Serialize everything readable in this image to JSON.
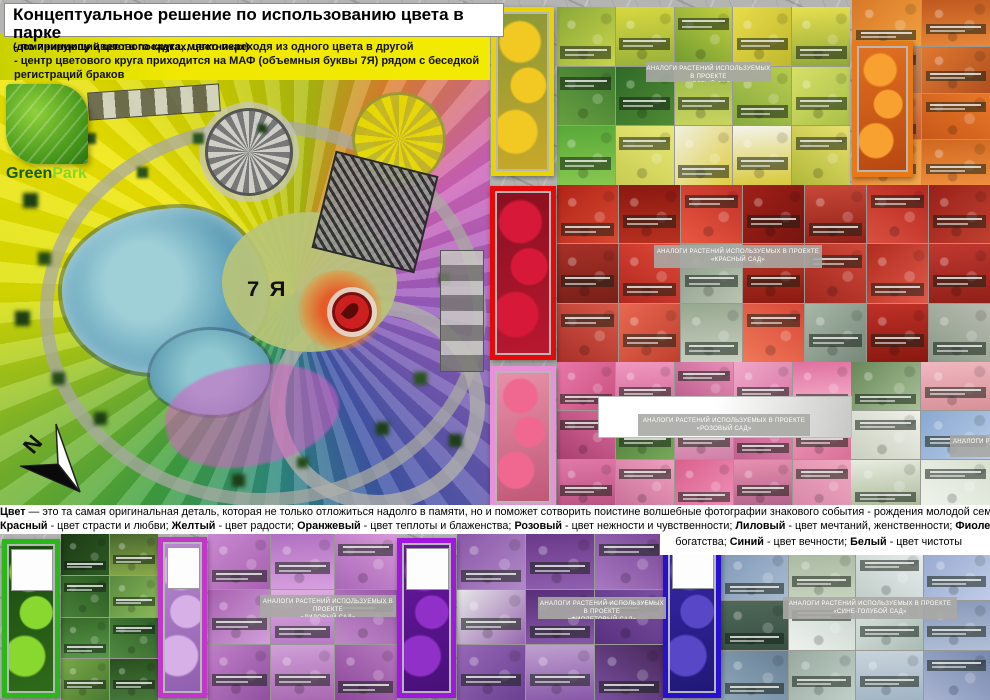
{
  "header": {
    "title": "Концептуальное решение по использованию цвета в парке",
    "subtitle": "(доминирующий цвет в посадках, цветниках)"
  },
  "notes": {
    "line1": "- по принципу цветового круга, мягко переходя из одного цвета в другой",
    "line2": "- центр цветового круга приходится на МАФ (объемныя буквы 7Я) рядом с беседкой регистраций браков"
  },
  "logo": {
    "word1": "Green",
    "word2": "Park"
  },
  "plan": {
    "center_label": "7 Я",
    "compass_letter": "N"
  },
  "description": {
    "line1": [
      {
        "t": "Цвет",
        "b": 1
      },
      {
        "t": " — это та самая оригинальная деталь, которая не только отложиться надолго в памяти, но и поможет  сотворить поистине волшебные фотографии знакового события - рождения молодой семьи."
      }
    ],
    "line2": [
      {
        "t": "Красный",
        "b": 1
      },
      {
        "t": " - цвет страсти и любви; "
      },
      {
        "t": "Желтый",
        "b": 1
      },
      {
        "t": " - цвет радости; "
      },
      {
        "t": "Оранжевый",
        "b": 1
      },
      {
        "t": " - цвет теплоты и блаженства; "
      },
      {
        "t": "Розовый",
        "b": 1
      },
      {
        "t": " - цвет нежности и чувственности; "
      },
      {
        "t": "Лиловый",
        "b": 1
      },
      {
        "t": " - цвет мечтаний, женственности; "
      },
      {
        "t": "Фиолетовый",
        "b": 1
      },
      {
        "t": " - цвет роскоши"
      }
    ],
    "line3": [
      {
        "t": "богатства; "
      },
      {
        "t": "Синий",
        "b": 1
      },
      {
        "t": " - цвет вечности; "
      },
      {
        "t": "Белый",
        "b": 1
      },
      {
        "t": "  - цвет чистоты"
      }
    ]
  },
  "sections": {
    "yellow": {
      "label": "АНАЛОГИ РАСТЕНИЙ ИСПОЛЬЗУЕМЫХ В ПРОЕКТЕ\n«ЖЕЛТЫЙ САД»"
    },
    "red": {
      "label": "АНАЛОГИ РАСТЕНИЙ ИСПОЛЬЗУЕМЫХ В ПРОЕКТЕ\n«КРАСНЫЙ САД»"
    },
    "pink": {
      "label": "АНАЛОГИ РАСТЕНИЙ ИСПОЛЬЗУЕМЫХ В ПРОЕКТЕ\n«РОЗОВЫЙ САД»"
    },
    "white": {
      "label": "АНАЛОГИ РАСТЕНИЙ ИСПОЛЬЗУЕМЫХ В ПРОЕКТЕ"
    },
    "lilac": {
      "label": "АНАЛОГИ РАСТЕНИЙ ИСПОЛЬЗУЕМЫХ В ПРОЕКТЕ\n«ЛИЛОВЫЙ САД»"
    },
    "violet": {
      "label": "АНАЛОГИ РАСТЕНИЙ ИСПОЛЬЗУЕМЫХ В ПРОЕКТЕ\n«ФИОЛЕТОВЫЙ САД»"
    },
    "blue": {
      "label": "АНАЛОГИ РАСТЕНИЙ ИСПОЛЬЗУЕМЫХ В ПРОЕКТЕ\n«СИНЕ-ГОЛУБОЙ САД»"
    }
  },
  "portraits": {
    "yellow": {
      "frame": "#e8d400",
      "box": false,
      "bg": [
        "#8a9838",
        "#c8a828"
      ],
      "fl": "#f2c822"
    },
    "orange": {
      "frame": "#e87818",
      "box": false,
      "bg": [
        "#e07020",
        "#b84810"
      ],
      "fl": "#f8a030"
    },
    "red": {
      "frame": "#e80808",
      "box": false,
      "bg": [
        "#8a1020",
        "#b81830"
      ],
      "fl": "#d81838"
    },
    "pink": {
      "frame": "#e890d8",
      "box": false,
      "bg": [
        "#e890a8",
        "#c05878"
      ],
      "fl": "#f06890"
    },
    "green": {
      "frame": "#28b818",
      "box": true,
      "bg": [
        "#1a4a10",
        "#2f6a1a"
      ],
      "fl": "#88d830"
    },
    "lilac": {
      "frame": "#c038c8",
      "box": true,
      "bg": [
        "#b888d0",
        "#9060b0"
      ],
      "fl": "#d8b0e8"
    },
    "purple": {
      "frame": "#a018e0",
      "box": true,
      "bg": [
        "#6a18a0",
        "#481078"
      ],
      "fl": "#9030c8"
    },
    "blue": {
      "frame": "#2810d0",
      "box": true,
      "bg": [
        "#3828a8",
        "#201878"
      ],
      "fl": "#5848c8"
    }
  },
  "galleries": {
    "yellow": {
      "cols": 5,
      "tiles": [
        [
          "#8aa838",
          "#c8d44a"
        ],
        [
          "#d8d840",
          "#98b03a"
        ],
        [
          "#c4d040",
          "#6f9a30"
        ],
        [
          "#e8dc48",
          "#c0b830"
        ],
        [
          "#e8e050",
          "#90a838"
        ],
        [
          "#3f7a30",
          "#68a040"
        ],
        [
          "#2f6a28",
          "#4f8a34"
        ],
        [
          "#9ab848",
          "#c8d460"
        ],
        [
          "#b8cc50",
          "#88aa40"
        ],
        [
          "#d8e068",
          "#a8c048"
        ],
        [
          "#58a838",
          "#88c850"
        ],
        [
          "#e8e878",
          "#c8cc50"
        ],
        [
          "#f0f0e0",
          "#e0cc40"
        ],
        [
          "#f4f4ec",
          "#d8c838"
        ],
        [
          "#e8e070",
          "#b0b838"
        ]
      ]
    },
    "orange": {
      "cols": 2,
      "tiles": [
        [
          "#d87828",
          "#f0a040"
        ],
        [
          "#c05820",
          "#e88838"
        ],
        [
          "#c88858",
          "#a86040"
        ],
        [
          "#e07830",
          "#b05020"
        ],
        [
          "#e08850",
          "#c06030"
        ],
        [
          "#e87828",
          "#c85818"
        ],
        [
          "#e88030",
          "#f0a850"
        ],
        [
          "#d06820",
          "#f09040"
        ]
      ]
    },
    "red": {
      "cols": 7,
      "tiles": [
        [
          "#b02418",
          "#d84830"
        ],
        [
          "#8a1810",
          "#b83020"
        ],
        [
          "#c03028",
          "#e85840"
        ],
        [
          "#a02018",
          "#781410"
        ],
        [
          "#c84838",
          "#902018"
        ],
        [
          "#b82820",
          "#d85040"
        ],
        [
          "#982018",
          "#c04030"
        ],
        [
          "#a83028",
          "#782018"
        ],
        [
          "#e04838",
          "#b02820"
        ],
        [
          "#8a9a8a",
          "#b8c4b0"
        ],
        [
          "#c23a28",
          "#8a1a12"
        ],
        [
          "#d04838",
          "#a02820"
        ],
        [
          "#b02c20",
          "#e05848"
        ],
        [
          "#c03830",
          "#902018"
        ],
        [
          "#d85848",
          "#a83028"
        ],
        [
          "#e86850",
          "#c04030"
        ],
        [
          "#98a890",
          "#c8d0c0"
        ],
        [
          "#d84838",
          "#f07858"
        ],
        [
          "#a8b8a8",
          "#788878"
        ],
        [
          "#c03028",
          "#881810"
        ],
        [
          "#b8bcb0",
          "#8a9a88"
        ]
      ]
    },
    "pink": {
      "cols": 5,
      "tiles": [
        [
          "#e878a8",
          "#c85080"
        ],
        [
          "#f098c0",
          "#d06898"
        ],
        [
          "#e890b8",
          "#b85888"
        ],
        [
          "#f0a8c8",
          "#d878a8"
        ],
        [
          "#e070a0",
          "#f8b8d0"
        ],
        [
          "#d86898",
          "#a84070"
        ],
        [
          "#4a7a3a",
          "#78a858"
        ],
        [
          "#f0b0c8",
          "#d080a8"
        ],
        [
          "#e888b0",
          "#c06090"
        ],
        [
          "#f098b8",
          "#d87098"
        ],
        [
          "#e078a8",
          "#b85080"
        ],
        [
          "#f0a0c0",
          "#c87098"
        ],
        [
          "#d8608c",
          "#f090b8"
        ],
        [
          "#e890b0",
          "#b06088"
        ],
        [
          "#f0a8c0",
          "#d888a8"
        ]
      ]
    },
    "white": {
      "cols": 2,
      "tiles": [
        [
          "#688858",
          "#a8c098"
        ],
        [
          "#f0b8c0",
          "#d89098"
        ],
        [
          "#f0f0e8",
          "#c8d0c0"
        ],
        [
          "#88a8d0",
          "#b8cce8"
        ],
        [
          "#e8ece0",
          "#a8b898"
        ],
        [
          "#d8e0d0",
          "#f0f4ec"
        ]
      ]
    },
    "green": {
      "cols": 2,
      "tiles": [
        [
          "#1a3a14",
          "#2f5a24"
        ],
        [
          "#486830",
          "#88a848"
        ],
        [
          "#2a5a22",
          "#488038"
        ],
        [
          "#5a8a40",
          "#88b858"
        ],
        [
          "#386a2a",
          "#58984a"
        ],
        [
          "#2f6028",
          "#508840"
        ],
        [
          "#78a848",
          "#4a7a30"
        ],
        [
          "#28501e",
          "#48783a"
        ]
      ]
    },
    "lilac": {
      "cols": 3,
      "tiles": [
        [
          "#c88ad0",
          "#a860b0"
        ],
        [
          "#b070c0",
          "#d8a0e0"
        ],
        [
          "#d898d8",
          "#a868b8"
        ],
        [
          "#a860b0",
          "#d0a0d8"
        ],
        [
          "#e0b0e0",
          "#b878c8"
        ],
        [
          "#9858a8",
          "#c088c8"
        ],
        [
          "#c080c8",
          "#9050a0"
        ],
        [
          "#d0a0d8",
          "#a868b0"
        ],
        [
          "#b878c0",
          "#8a4898"
        ]
      ]
    },
    "violet": {
      "cols": 3,
      "tiles": [
        [
          "#8a58a8",
          "#b088c8"
        ],
        [
          "#6a3888",
          "#9060b0"
        ],
        [
          "#7a4898",
          "#a878c0"
        ],
        [
          "#e8e8e8",
          "#9868b0"
        ],
        [
          "#583078",
          "#8858a8"
        ],
        [
          "#7a50a0",
          "#583080"
        ],
        [
          "#9868b8",
          "#6a4090"
        ],
        [
          "#c0a0d0",
          "#8858a8"
        ],
        [
          "#48285a",
          "#7a50a0"
        ]
      ]
    },
    "blue": {
      "cols": 4,
      "tiles": [
        [
          "#8098b8",
          "#a8bcd0"
        ],
        [
          "#a8b8a0",
          "#c8d4c0"
        ],
        [
          "#e8eeee",
          "#c0ccc8"
        ],
        [
          "#98aad0",
          "#c0cce8"
        ],
        [
          "#506858",
          "#385044"
        ],
        [
          "#c8d4cc",
          "#eef2ee"
        ],
        [
          "#dce4e0",
          "#aabcb4"
        ],
        [
          "#8898b8",
          "#b0c0d8"
        ],
        [
          "#688098",
          "#90a8b8"
        ],
        [
          "#98aaa0",
          "#c0d0c8"
        ],
        [
          "#c8d4dc",
          "#a0b4c4"
        ],
        [
          "#7888b0",
          "#a8b4d0"
        ]
      ]
    }
  }
}
